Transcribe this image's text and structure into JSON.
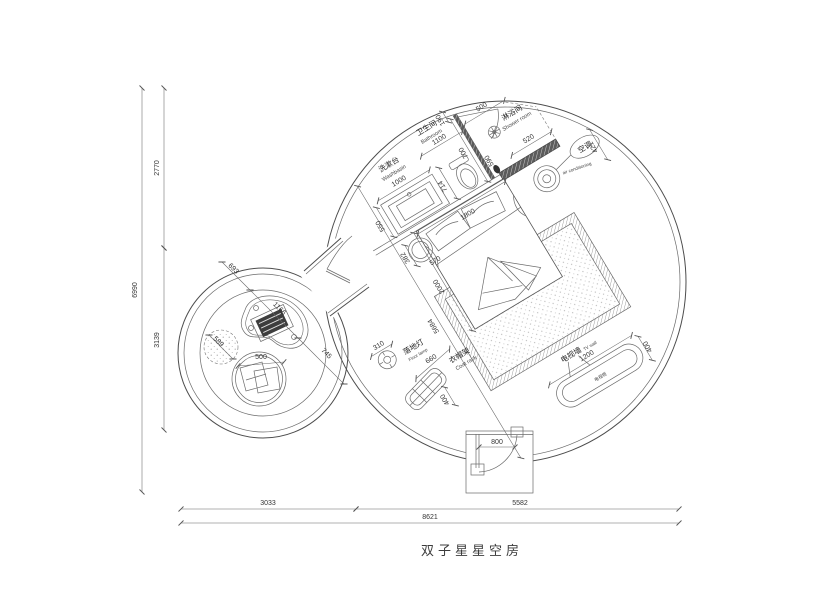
{
  "drawing_title": "双子星星空房",
  "dimensions": {
    "overall": {
      "total_height": "6990",
      "upper_height": "2770",
      "lower_height": "3139",
      "left_width": "3033",
      "right_width": "5582",
      "total_width": "8621"
    },
    "bathroom": {
      "washbasin_width": "1000",
      "counter_depth": "550",
      "bathroom_width": "1100",
      "wall_gap": "190",
      "partition_length": "700",
      "shower_width": "500",
      "drain_offset": "590",
      "toilet_offset": "714",
      "bench_length": "520",
      "ac_offset": "421"
    },
    "bedroom": {
      "bed_width": "1800",
      "bed_length": "2000",
      "room_diagonal": "5684",
      "stool_offset": "382",
      "stool_diameter": "570",
      "entry_door_width": "800"
    },
    "accessories": {
      "lamp_diameter": "310",
      "coat_rack_length": "660",
      "coat_rack_depth": "400",
      "tv_wall_length": "1200",
      "tv_wall_depth": "400"
    },
    "lounge": {
      "wall_to_table": "693",
      "table_length": "1166",
      "table_to_door": "745",
      "beanbag_diameter": "589",
      "chair_diameter": "500"
    }
  },
  "labels": {
    "washbasin_cn": "洗漱台",
    "washbasin_en": "Washbasin",
    "bathroom_cn": "卫生间",
    "bathroom_en": "Bathroom",
    "shower_cn": "淋浴间",
    "shower_en": "Shower room",
    "ac_cn": "空调",
    "ac_en": "air conditioning",
    "lamp_cn": "落地灯",
    "lamp_en": "Floor lamp",
    "rack_cn": "衣帽架",
    "rack_en": "Coat rack",
    "tv_cn": "电视墙",
    "tv_en": "TV wall",
    "tv_cabinet": "电视柜"
  }
}
